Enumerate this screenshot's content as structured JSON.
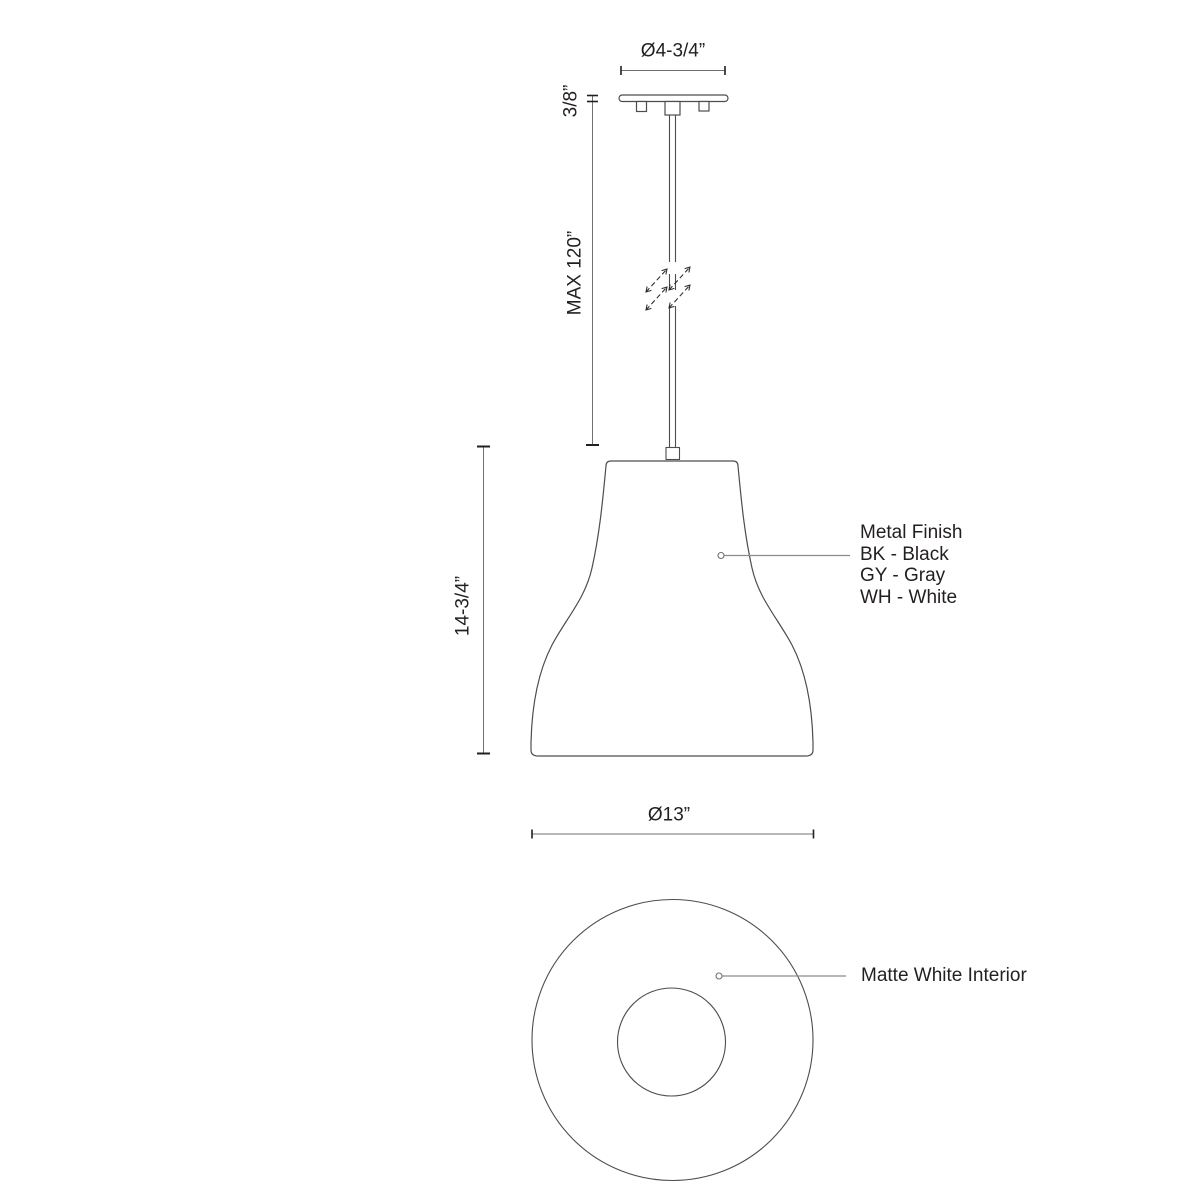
{
  "drawing": {
    "subject": "pendant-light-dimension-drawing",
    "views": [
      "side-view",
      "bottom-view"
    ]
  },
  "dimensions": {
    "canopy_diameter": "Ø4-3/4”",
    "canopy_thickness": "3/8”",
    "suspension_max_length": "MAX 120”",
    "shade_height": "14-3/4”",
    "shade_diameter": "Ø13”"
  },
  "callouts": {
    "metal_finish": {
      "title": "Metal Finish",
      "options": [
        "BK - Black",
        "GY - Gray",
        "WH - White"
      ]
    },
    "interior": "Matte White Interior"
  },
  "colors": {
    "background": "#ffffff",
    "outline": "#4d4d4d",
    "dimension_line": "#6f6f6f",
    "leader_line": "#8c8c8c",
    "tick_and_text": "#231f20"
  }
}
